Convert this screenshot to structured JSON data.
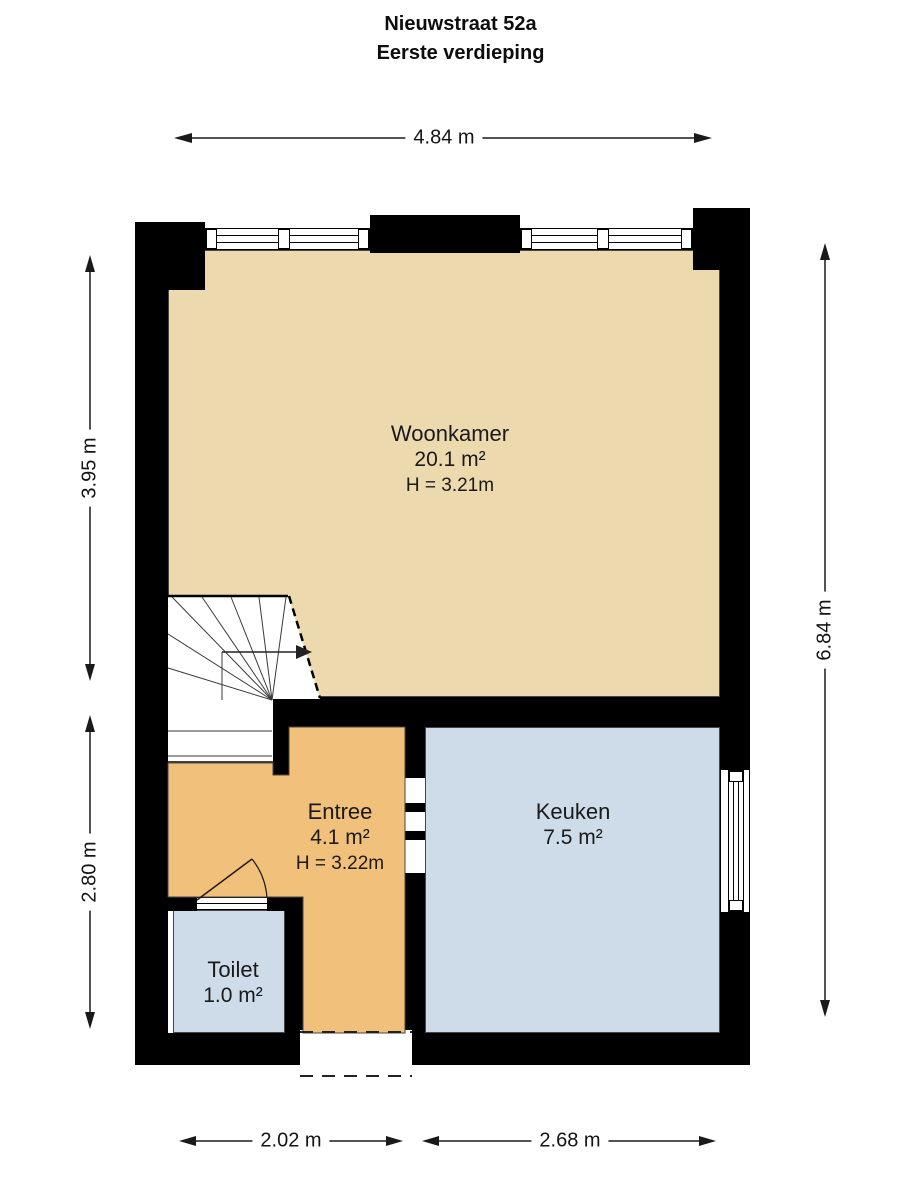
{
  "title": {
    "line1": "Nieuwstraat 52a",
    "line2": "Eerste verdieping"
  },
  "dims": {
    "top": "4.84 m",
    "left_upper": "3.95 m",
    "left_lower": "2.80 m",
    "right": "6.84 m",
    "bottom_left": "2.02 m",
    "bottom_right": "2.68 m"
  },
  "rooms": {
    "woonkamer": {
      "name": "Woonkamer",
      "area": "20.1 m²",
      "height": "H = 3.21m"
    },
    "entree": {
      "name": "Entree",
      "area": "4.1 m²",
      "height": "H = 3.22m"
    },
    "keuken": {
      "name": "Keuken",
      "area": "7.5 m²"
    },
    "toilet": {
      "name": "Toilet",
      "area": "1.0 m²"
    }
  },
  "features": {
    "staircase": "winder-staircase-with-up-arrow",
    "top_windows": 2,
    "right_window": 1,
    "toilet_door": "door-with-swing-arc",
    "entree_keuken_opening": "dashed-wall-opening",
    "front_entrance": "dashed-opening-bottom-wall"
  },
  "colors": {
    "woonkamer_floor": "#ecd9ae",
    "entree_floor": "#f1c17c",
    "keuken_floor": "#cedce9",
    "toilet_floor": "#cedce9",
    "wall": "#000000",
    "background": "#ffffff"
  }
}
